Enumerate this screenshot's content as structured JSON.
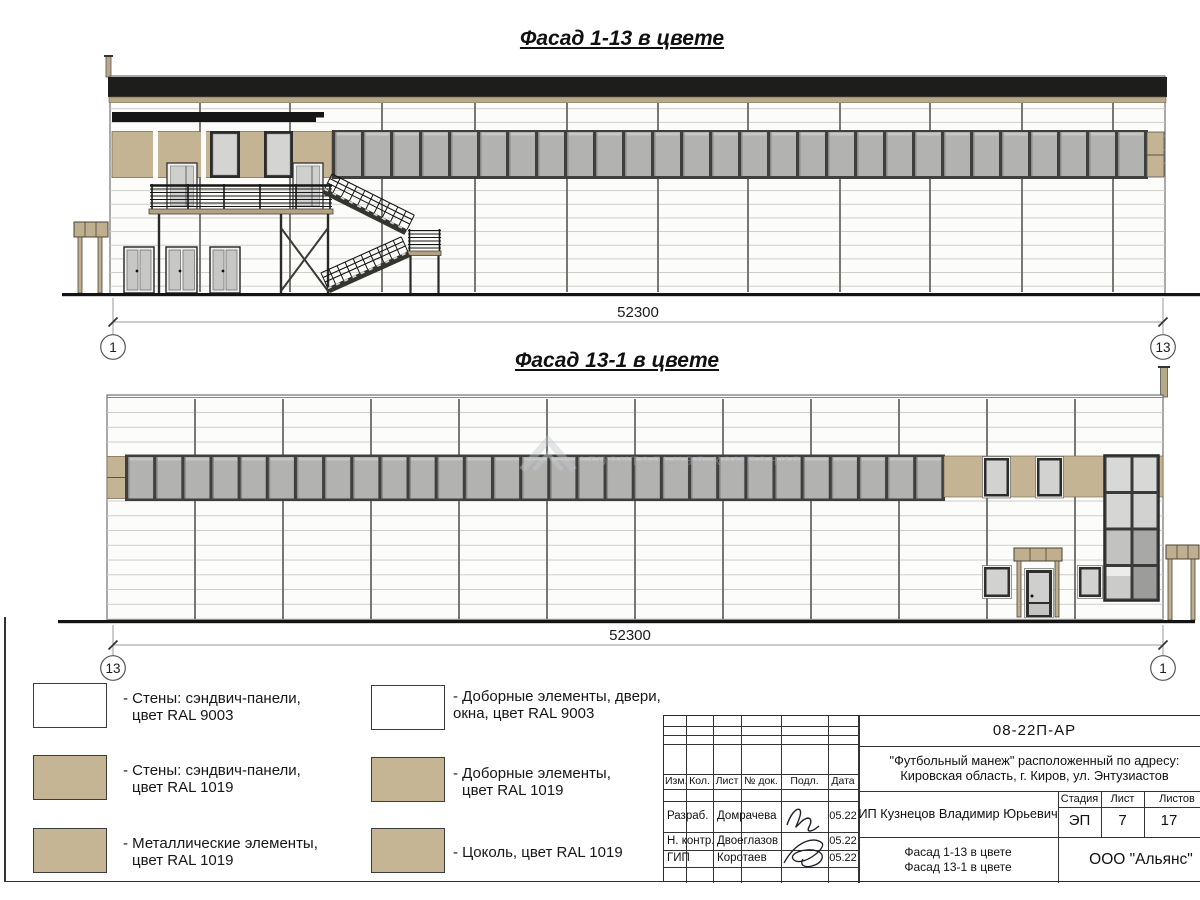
{
  "sheet": {
    "facade1": {
      "title": "Фасад 1-13 в цвете",
      "dim": "52300",
      "axis_left": "1",
      "axis_right": "13"
    },
    "facade2": {
      "title": "Фасад 13-1 в цвете",
      "dim": "52300",
      "axis_left": "13",
      "axis_right": "1"
    }
  },
  "watermark": {
    "text": "строительная компания"
  },
  "legend": {
    "col1": [
      {
        "line1": "- Стены: сэндвич-панели,",
        "line2": "цвет RAL 9003",
        "swatch": "#ffffff"
      },
      {
        "line1": "- Стены: сэндвич-панели,",
        "line2": "цвет RAL 1019",
        "swatch": "#c6b594"
      },
      {
        "line1": "- Металлические элементы,",
        "line2": "цвет RAL 1019",
        "swatch": "#c6b594"
      }
    ],
    "col2": [
      {
        "line1": "- Доборные элементы, двери,",
        "line2": "окна, цвет RAL 9003",
        "swatch": "#ffffff"
      },
      {
        "line1": "- Доборные элементы,",
        "line2": "цвет RAL 1019",
        "swatch": "#c6b594"
      },
      {
        "line1": "- Цоколь, цвет RAL 1019",
        "line2": "",
        "swatch": "#c6b594"
      }
    ]
  },
  "title_block": {
    "doc_number": "08-22П-АР",
    "project_line1": "\"Футбольный манеж\" расположенный по адресу:",
    "project_line2": "Кировская область, г. Киров, ул. Энтузиастов",
    "client": "ИП Кузнецов Владимир Юрьевич",
    "sheet_name_line1": "Фасад 1-13 в цвете",
    "sheet_name_line2": "Фасад 13-1 в цвете",
    "organization": "ООО \"Альянс\"",
    "headers": {
      "izm": "Изм.",
      "kol": "Кол.",
      "list": "Лист",
      "doc": "№ док.",
      "podp": "Подл.",
      "data": "Дата",
      "stage": "Стадия",
      "sheet": "Лист",
      "sheets": "Листов"
    },
    "stage_value": "ЭП",
    "sheet_value": "7",
    "sheets_value": "17",
    "roles": [
      {
        "role": "Разраб.",
        "name": "Домрачева",
        "date": "05.22"
      },
      {
        "role": "Н. контр.",
        "name": "Двоеглазов",
        "date": "05.22"
      },
      {
        "role": "ГИП",
        "name": "Коротаев",
        "date": "05.22"
      }
    ]
  },
  "colors": {
    "tan": "#c5b493",
    "roof_black": "#1d1d1c",
    "glass_grey": "#b2b2b0",
    "glass_light": "#d2d2d0",
    "frame_dark": "#3f3f3d"
  }
}
